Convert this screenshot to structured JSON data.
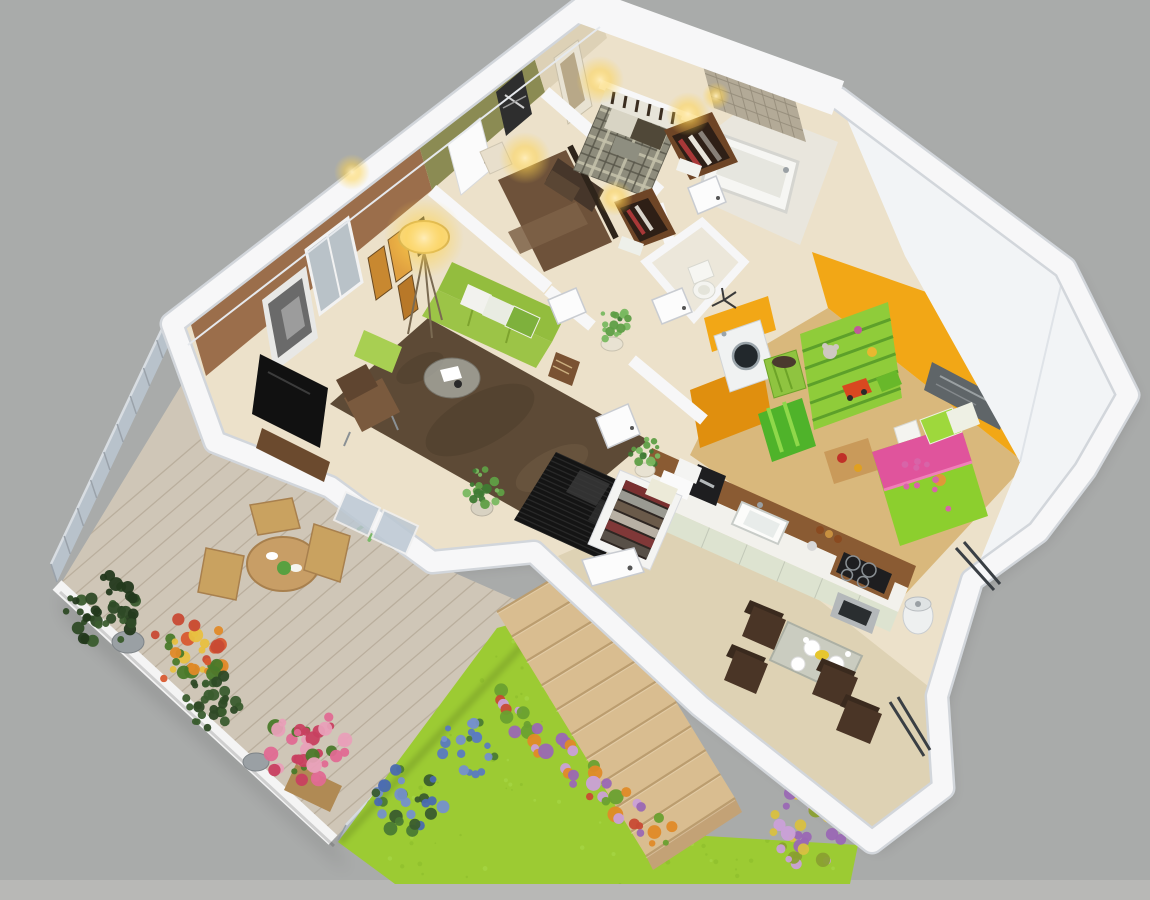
{
  "scene": {
    "type": "3d-isometric-floor-plan-render",
    "view": "aerial-cutaway-dollhouse",
    "rooms": [
      "master-bedroom",
      "second-bedroom",
      "bathroom",
      "wc",
      "hallway",
      "living-room",
      "laundry",
      "kids-bedroom",
      "kitchen",
      "dining-area",
      "entry",
      "terrace-deck",
      "garden-lawn"
    ]
  },
  "objects": {
    "terrace": [
      "wood-deck",
      "glass-railing",
      "white-parapet",
      "outdoor-round-table",
      "outdoor-chairs",
      "potted-palms",
      "hedge-planters",
      "orange-flower-planter",
      "pink-flower-planter"
    ],
    "living_room": [
      "green-sofa",
      "throw-pillows",
      "green-pouf",
      "glass-coffee-table",
      "brown-armchair",
      "brown-shag-rug",
      "tv-on-cabinet",
      "floor-lamp",
      "gallery-frames",
      "city-photo",
      "windows"
    ],
    "master_bedroom": [
      "plaid-double-bed",
      "slat-headboard",
      "wall-sconces",
      "open-closet-shelves",
      "framed-picture"
    ],
    "second_bedroom": [
      "brown-double-bed",
      "pillows",
      "nightstand",
      "wall-sconces",
      "open-closet-shelves",
      "white-door",
      "dark-wall-art"
    ],
    "bathroom": [
      "mosaic-tile-wall",
      "bathtub",
      "open-door"
    ],
    "wc": [
      "toilet",
      "towel-stand"
    ],
    "laundry": [
      "washing-machine",
      "green-laundry-basket",
      "orange-walls"
    ],
    "kids_bedroom": [
      "green-toy-shelf",
      "plush-toys",
      "toy-car",
      "green-striped-toy-box",
      "green-pink-single-bed",
      "window",
      "orange-walls",
      "floor-toys",
      "nightstand"
    ],
    "kitchen": [
      "wood-bar-counter",
      "white-countertop",
      "sink",
      "coffee-maker",
      "cooktop",
      "oven",
      "spice-jars",
      "trash-bin",
      "pale-green-cabinets"
    ],
    "dining_area": [
      "glass-dining-table",
      "dark-brown-chairs",
      "plates",
      "cups"
    ],
    "entry": [
      "black-diamond-mat",
      "open-wardrobe-with-clothes",
      "potted-plants",
      "open-doors",
      "terrace-glass-doors"
    ],
    "garden": [
      "bright-lawn",
      "wood-stairs",
      "flower-bed-strip",
      "blue-flower-bushes",
      "purple-flower-bush"
    ]
  },
  "colors": {
    "bg": "#a9abaa",
    "bg_bottom": "#b8b8b6",
    "wall_white": "#f7f7f8",
    "wall_edge": "#d2d6db",
    "wall_face": "#f2f4f6",
    "floor_cream": "#ece1ca",
    "floor_dining": "#ded2b4",
    "floor_kids": "#d9b87c",
    "floor_bath": "#e9e6dd",
    "rug": "#5d4a36",
    "sofa": "#93bd3e",
    "sofa_seat": "#9cc447",
    "pouf": "#a8cf52",
    "accent_brown": "#9b6e4b",
    "accent_olive": "#8b8b53",
    "accent_beige": "#ddd1b6",
    "orange_wall": "#f2a716",
    "orange_wall_dark": "#e08f0e",
    "kids_bed": "#8ccf2e",
    "kids_pink": "#e0549c",
    "shelf": "#8fcc3a",
    "shelf_line": "#5da02a",
    "toybox": "#4fb32a",
    "bed_brown": "#6e523a",
    "pillow_dark": "#46362a",
    "headboard": "#3a2d20",
    "plaid_base": "#8e8c7c",
    "plaid_light": "#c6c2ac",
    "plaid_dark": "#5a584c",
    "deck": "#cfc6b7",
    "deck_seam": "#b3a795",
    "lawn": "#9ccb33",
    "speckle_dark": "#8abc2a",
    "speckle_light": "#aada4a",
    "stairs": "#d9bd90",
    "stair_edge": "#bb9d6f",
    "glass": "#bcc8d3",
    "rail_post": "#9aa2aa",
    "hedge": "#2e4a26",
    "palm": "#79b868",
    "palm_dark": "#5f9e4c",
    "table_wood": "#c89e66",
    "chair_wood": "#c9a260",
    "dining_chair": "#4a3526",
    "counter_wood": "#8a5b33",
    "counter_top": "#f2f1ec",
    "cabinet": "#dde3d0",
    "appliance": "#1e1e20",
    "steel": "#b4b8ba",
    "tile": "#b3aa97",
    "tile_line": "#948c7a",
    "mat": "#141414",
    "wardrobe_in": "#2e2622",
    "tv": "#111111",
    "tub": "#f6f6f3",
    "washer": "#f0f2f2",
    "basket": "#8fc440",
    "glass_table": "#c2cac6",
    "glow": "#ffd24d"
  },
  "decor": {
    "deck_planks": {
      "from": [
        46,
        572
      ],
      "to": [
        352,
        852
      ],
      "count": 24,
      "dir": [
        0.76,
        -0.65
      ],
      "len": 640
    },
    "stair_treads": {
      "l1": [
        497,
        612
      ],
      "l2": [
        646,
        856
      ],
      "r1": [
        588,
        558
      ],
      "r2": [
        735,
        798
      ],
      "count": 11
    },
    "lawn_speckles": {
      "count": 150,
      "box": [
        335,
        612,
        525,
        274
      ]
    },
    "flower_strip": {
      "from": [
        492,
        702
      ],
      "to": [
        668,
        840
      ],
      "count": 44,
      "spread": 15,
      "rmin": 3,
      "rmax": 8,
      "colors": [
        "#9a68b4",
        "#e08a28",
        "#6aa030",
        "#c84a34",
        "#caa0d8"
      ]
    },
    "clusters": [
      {
        "name": "hedge-planter-a",
        "layer": "terrace",
        "cx": 102,
        "cy": 610,
        "r": 36,
        "n": 42,
        "rmin": 3,
        "rmax": 7,
        "colors": [
          "#2e4a26",
          "#3a5c2e",
          "#23391c"
        ]
      },
      {
        "name": "terrace-flowers-orange",
        "layer": "terrace",
        "cx": 188,
        "cy": 650,
        "r": 38,
        "n": 36,
        "rmin": 3,
        "rmax": 8,
        "colors": [
          "#e08a28",
          "#c84a34",
          "#4a7a2a",
          "#e8c040",
          "#d85a30"
        ]
      },
      {
        "name": "hedge-planter-b",
        "layer": "terrace",
        "cx": 212,
        "cy": 702,
        "r": 29,
        "n": 30,
        "rmin": 3,
        "rmax": 6,
        "colors": [
          "#2e4a26",
          "#3a5c2e"
        ]
      },
      {
        "name": "terrace-flowers-pink",
        "layer": "terrace",
        "cx": 306,
        "cy": 748,
        "r": 40,
        "n": 38,
        "rmin": 3,
        "rmax": 8,
        "colors": [
          "#e06a92",
          "#c84060",
          "#4a7a2a",
          "#e8a0b8"
        ]
      },
      {
        "name": "lawn-flowers-blue-a",
        "layer": "garden",
        "cx": 408,
        "cy": 800,
        "r": 36,
        "n": 28,
        "rmin": 3,
        "rmax": 7,
        "colors": [
          "#7590cc",
          "#4a6ab0",
          "#4a7a34",
          "#3a5c2e"
        ]
      },
      {
        "name": "lawn-flowers-blue-b",
        "layer": "garden",
        "cx": 468,
        "cy": 748,
        "r": 28,
        "n": 20,
        "rmin": 3,
        "rmax": 6,
        "colors": [
          "#7590cc",
          "#5a7ac0",
          "#4a7a34"
        ]
      },
      {
        "name": "lawn-flowers-purple",
        "layer": "garden",
        "cx": 806,
        "cy": 828,
        "r": 40,
        "n": 34,
        "rmin": 3,
        "rmax": 8,
        "colors": [
          "#9a68b4",
          "#caa0d8",
          "#8aa030",
          "#d8c040"
        ]
      },
      {
        "name": "hall-plant-a",
        "layer": "interior",
        "cx": 614,
        "cy": 326,
        "r": 17,
        "n": 16,
        "rmin": 2,
        "rmax": 5,
        "colors": [
          "#5f9e46",
          "#79b860",
          "#3f7a34"
        ]
      },
      {
        "name": "hall-plant-b",
        "layer": "interior",
        "cx": 646,
        "cy": 452,
        "r": 16,
        "n": 14,
        "rmin": 2,
        "rmax": 5,
        "colors": [
          "#5f9e46",
          "#79b860",
          "#3f7a34"
        ]
      },
      {
        "name": "living-plant",
        "layer": "interior",
        "cx": 482,
        "cy": 488,
        "r": 20,
        "n": 18,
        "rmin": 2,
        "rmax": 5,
        "colors": [
          "#5f9e46",
          "#79b860",
          "#3f7a34"
        ]
      }
    ],
    "palms": [
      {
        "cx": 258,
        "cy": 428,
        "r": 42
      },
      {
        "cx": 386,
        "cy": 510,
        "r": 38
      }
    ],
    "rails": [
      {
        "name": "railing-nw",
        "from": [
          176,
          330
        ],
        "to": [
          57,
          582
        ],
        "posts": 9,
        "rise": [
          -6,
          -18
        ]
      },
      {
        "name": "railing-se",
        "from": [
          544,
          620
        ],
        "to": [
          338,
          840
        ],
        "posts": 9,
        "rise": [
          8,
          -15
        ]
      }
    ],
    "plaid": {
      "steps": 8
    },
    "mat_stripes": {
      "count": 16
    },
    "tile": {
      "steps": 8
    },
    "wardrobe_items": [
      "#7a3030",
      "#9a9a92",
      "#6a5a4a",
      "#b8b0a4",
      "#803838",
      "#585048"
    ],
    "kidsbed_dots": 9,
    "glows": [
      {
        "x": 525,
        "y": 158,
        "r": 26
      },
      {
        "x": 615,
        "y": 198,
        "r": 18
      },
      {
        "x": 600,
        "y": 80,
        "r": 24
      },
      {
        "x": 688,
        "y": 114,
        "r": 22
      },
      {
        "x": 352,
        "y": 172,
        "r": 18
      },
      {
        "x": 716,
        "y": 96,
        "r": 14
      },
      {
        "x": 424,
        "y": 238,
        "r": 40
      }
    ]
  }
}
